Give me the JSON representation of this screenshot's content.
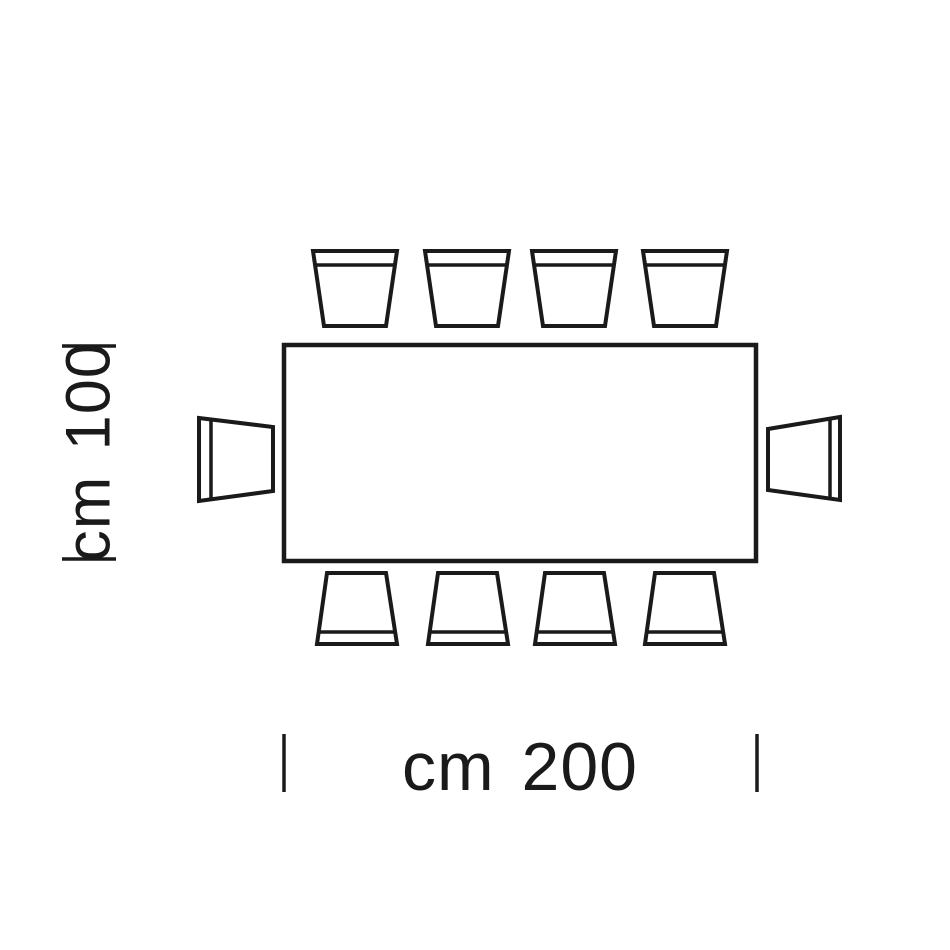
{
  "page": {
    "background_color": "#ffffff",
    "ink_color": "#1a1a1a"
  },
  "diagram": {
    "kind": "table-seating-plan-top-view",
    "table": {
      "width_cm": 200,
      "depth_cm": 100,
      "seats_total": 10,
      "seats_top": 4,
      "seats_bottom": 4,
      "seats_left": 1,
      "seats_right": 1
    },
    "dimensions": {
      "width_label": "cm 200",
      "depth_label": "cm 100"
    }
  }
}
